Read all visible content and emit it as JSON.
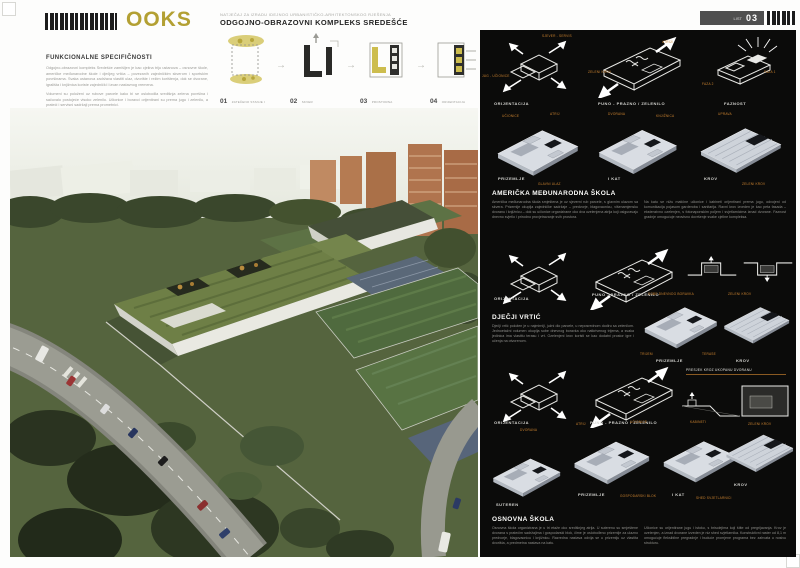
{
  "header": {
    "logo_text": "OOKS",
    "competition_line": "NATJEČAJ ZA IZRADU IDEJNOG URBANISTIČKO-ARHITEKTONSKOG RJEŠENJA",
    "title": "ODGOJNO-OBRAZOVNI KOMPLEKS SREDEŠĆE",
    "sheet_label": "LIST",
    "sheet_number": "03"
  },
  "left": {
    "section_title": "FUNKCIONALNE SPECIFIČNOSTI",
    "paragraphs": [
      "Odgojno-obrazovni kompleks Sredešće zamišljen je kao cjelina triju ustanova – osnovne škole, američke međunarodne škole i dječjeg vrtića – povezanih zajedničkim skverom i sportskim površinama. Svaka ustanova zadržava vlastiti ulaz, dvorište i režim korištenja, dok se dvorane, igrališta i knjižnica koriste zajednički i izvan nastavnog vremena.",
      "Volumeni su položeni uz rubove parcele kako bi se oslobodila središnja zelena površina i sačuvalo postojeće visoko zelenilo. Učionice i boravci orijentirani su prema jugu i zelenilu, a prateći i servisni sadržaji prema prometnici."
    ],
    "concept_steps": [
      {
        "num": "01",
        "label": "ZATEČENO STANJE I ZELENILO"
      },
      {
        "num": "02",
        "label": "SKVER"
      },
      {
        "num": "03",
        "label": "PROSTORNA ORGANIZACIJA"
      },
      {
        "num": "04",
        "label": "ORIJENTACIJA SADRŽAJA"
      }
    ]
  },
  "right": {
    "row1": {
      "captions": [
        "ORIJENTACIJA",
        "PUNO - PRAZNO / ZELENILO",
        "FAZNOST"
      ],
      "diag_labels": [
        "JUG - UČIONICE",
        "SJEVER - SERVIS",
        "ZELENI KROV",
        "ATRIJI",
        "FAZA 1",
        "FAZA 2"
      ]
    },
    "school1": {
      "title": "AMERIČKA MEĐUNARODNA ŠKOLA",
      "col1": "Američka međunarodna škola smještena je uz sjeverni rub parcele, s glavnim ulazom sa skvera. Prizemlje okuplja zajedničke sadržaje – predvorje, blagovaonicu, višenamjensku dvoranu i knjižnicu – dok su učionice organizirane oko dva ozelenjena atrija koji osiguravaju dnevno svjetlo i prirodno provjetravanje svih prostora.",
      "col2": "Na katu se nižu matične učionice i kabineti orijentirani prema jugu, odvojeni od komunikacija pojasom garderoba i sanitarija. Ravni krov izveden je kao peta fasada – ekstenzivno ozelenjen, s fotonaponskim poljem i svjetlarnicima iznad dvorane. Faznost gradnje omogućuje neovisno dovršenje svake cjeline kompleksa.",
      "plates": [
        "PRIZEMLJE",
        "I KAT",
        "KROV"
      ],
      "labels": [
        "UČIONICE",
        "ATRIJ",
        "DVORANA",
        "KNJIŽNICA",
        "UPRAVA",
        "GLAVNI ULAZ",
        "ZELENI KROV"
      ]
    },
    "kindergarten": {
      "title": "DJEČJI VRTIĆ",
      "text": "Dječji vrtić položen je u najmirniji, južni dio parcele, u neposrednom dodiru sa zelenilom. Jednoetažni volumen okuplja sobe dnevnog boravka oko natkrivenog trijema, a svaka jedinica ima vlastitu terasu i vrt. Ozelenjeni krov koristi se kao dodatni prostor igre i učenja na otvorenom.",
      "captions": [
        "ORIJENTACIJA",
        "PUNO - PRAZNO / ZELENILO"
      ],
      "plates": [
        "PRIZEMLJE",
        "KROV"
      ],
      "labels": [
        "SOBE DNEVNOG BORAVKA",
        "TRIJEM",
        "TERASE",
        "ZELENI KROV"
      ]
    },
    "school2": {
      "title": "OSNOVNA ŠKOLA",
      "col1": "Osnovna škola organizirana je u tri etaže oko središnjeg atrija. U suterenu su smještene dvorana s pratećim sadržajima i gospodarski blok, čime je oslobođeno prizemlje za ulazno predvorje, blagovaonicu i knjižnicu. Razredna nastava odvija se u prizemlju uz vlastita dvorišta, a predmetna nastava na katu.",
      "col2": "Učionice su orijentirane jugu i istoku, s brisolejima koji štite od pregrijavanja. Krov je ozelenjen, a iznad dvorane izveden je niz shed svjetlarnika. Konstruktivni raster od 8,1 m omogućuje fleksibilne pregradnje i buduće promjene programa bez zahvata u nosivu strukturu.",
      "captions": [
        "ORIJENTACIJA",
        "PUNO - PRAZNO / ZELENILO"
      ],
      "detail_caption": "PRESJEK KROZ UKOPANU DVORANU",
      "plates": [
        "SUTEREN",
        "PRIZEMLJE",
        "I KAT",
        "KROV"
      ],
      "labels": [
        "DVORANA",
        "GOSPODARSKI BLOK",
        "ATRIJ",
        "UČIONICE",
        "KABINETI",
        "SHED SVJETLARNICI",
        "ZELENI KROV"
      ]
    }
  },
  "colors": {
    "accent_gold": "#b3a033",
    "accent_orange": "#c9812f",
    "panel_background": "#0b0b0a"
  }
}
